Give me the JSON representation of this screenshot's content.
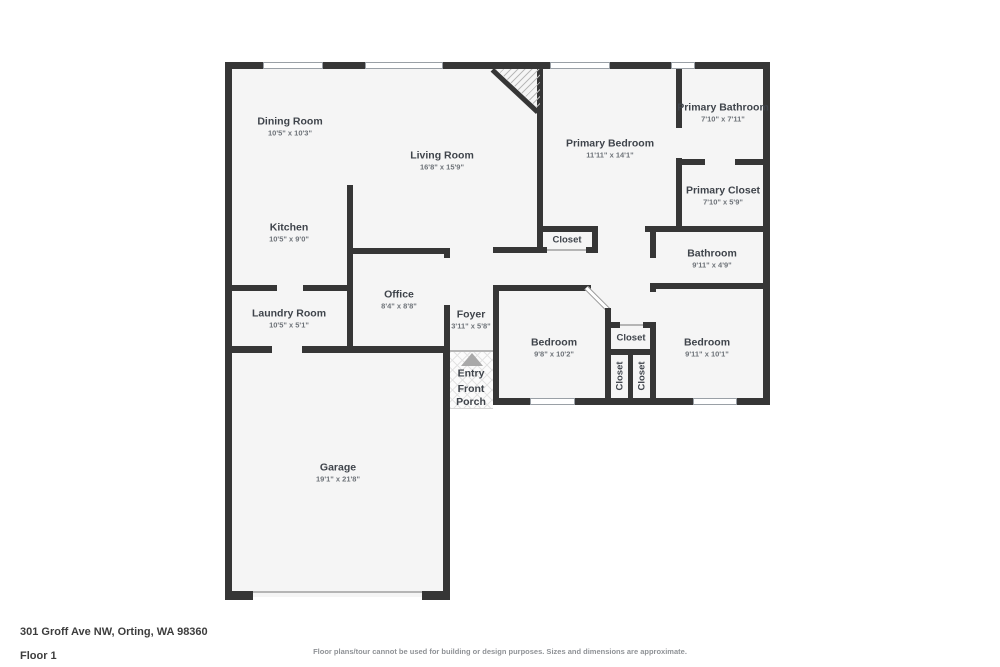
{
  "meta": {
    "address": "301 Groff Ave NW, Orting, WA 98360",
    "floor_label": "Floor 1",
    "disclaimer": "Floor plans/tour cannot be used for building or design purposes. Sizes and dimensions are approximate."
  },
  "colors": {
    "wall": "#363636",
    "room_fill": "#f5f5f5",
    "room_name_text": "#3f444b",
    "dimension_text": "#6d7278",
    "window_outline": "#9aa0a6",
    "entry_arrow": "#a9a9a9"
  },
  "rooms": {
    "dining": {
      "name": "Dining Room",
      "dims": "10'5\" x 10'3\""
    },
    "living": {
      "name": "Living Room",
      "dims": "16'8\" x 15'9\""
    },
    "kitchen": {
      "name": "Kitchen",
      "dims": "10'5\" x 9'0\""
    },
    "laundry": {
      "name": "Laundry Room",
      "dims": "10'5\" x 5'1\""
    },
    "office": {
      "name": "Office",
      "dims": "8'4\" x 8'8\""
    },
    "foyer": {
      "name": "Foyer",
      "dims": "3'11\" x 5'8\""
    },
    "garage": {
      "name": "Garage",
      "dims": "19'1\" x 21'8\""
    },
    "primary_bedroom": {
      "name": "Primary Bedroom",
      "dims": "11'11\" x 14'1\""
    },
    "primary_bathroom": {
      "name": "Primary Bathroom",
      "dims": "7'10\" x 7'11\""
    },
    "primary_closet": {
      "name": "Primary Closet",
      "dims": "7'10\" x 5'9\""
    },
    "bathroom": {
      "name": "Bathroom",
      "dims": "9'11\" x 4'9\""
    },
    "bedroom_center": {
      "name": "Bedroom",
      "dims": "9'8\" x 10'2\""
    },
    "bedroom_right": {
      "name": "Bedroom",
      "dims": "9'11\" x 10'1\""
    }
  },
  "closets": {
    "primary_hall": "Closet",
    "hall_block": "Closet",
    "block_left": "Closet",
    "block_right": "Closet"
  },
  "entry": {
    "label": "Entry",
    "porch_label": "Front Porch"
  }
}
